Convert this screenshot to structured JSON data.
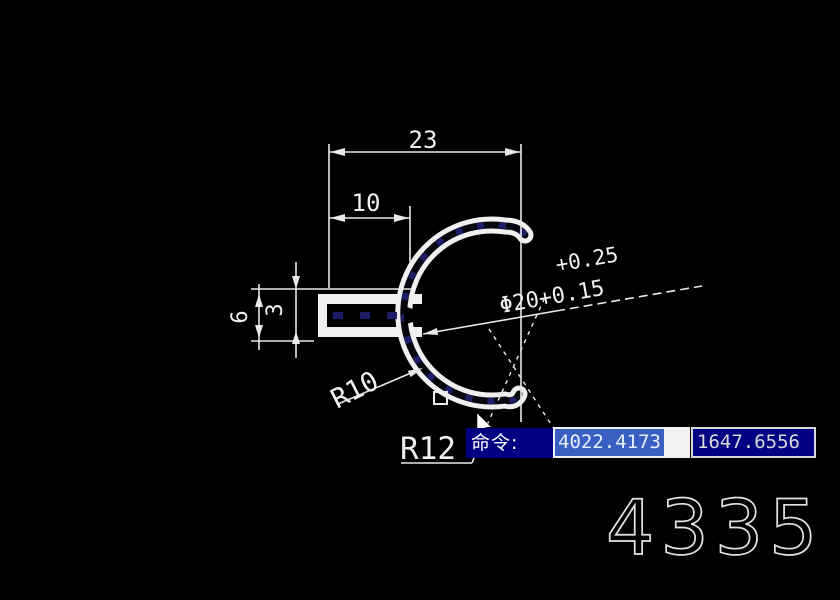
{
  "drawing": {
    "dimensions": {
      "total_width": "23",
      "arm_length": "10",
      "arm_height": "6",
      "slot_height": "3",
      "tolerance_upper": "+0.25",
      "diameter_with_lower_tolerance": "Φ20+0.15",
      "inner_radius": "R10",
      "outer_radius": "R12"
    },
    "part_number": "4335"
  },
  "command_bar": {
    "prompt_label": "命令:",
    "coordinate_x": "4022.4173",
    "coordinate_y": "1647.6556"
  },
  "colors": {
    "background": "#000000",
    "line": "#f0f0f0",
    "command_background": "#000082",
    "selection_highlight": "#3a5fc2",
    "core_hatch": "#1d1d68"
  }
}
